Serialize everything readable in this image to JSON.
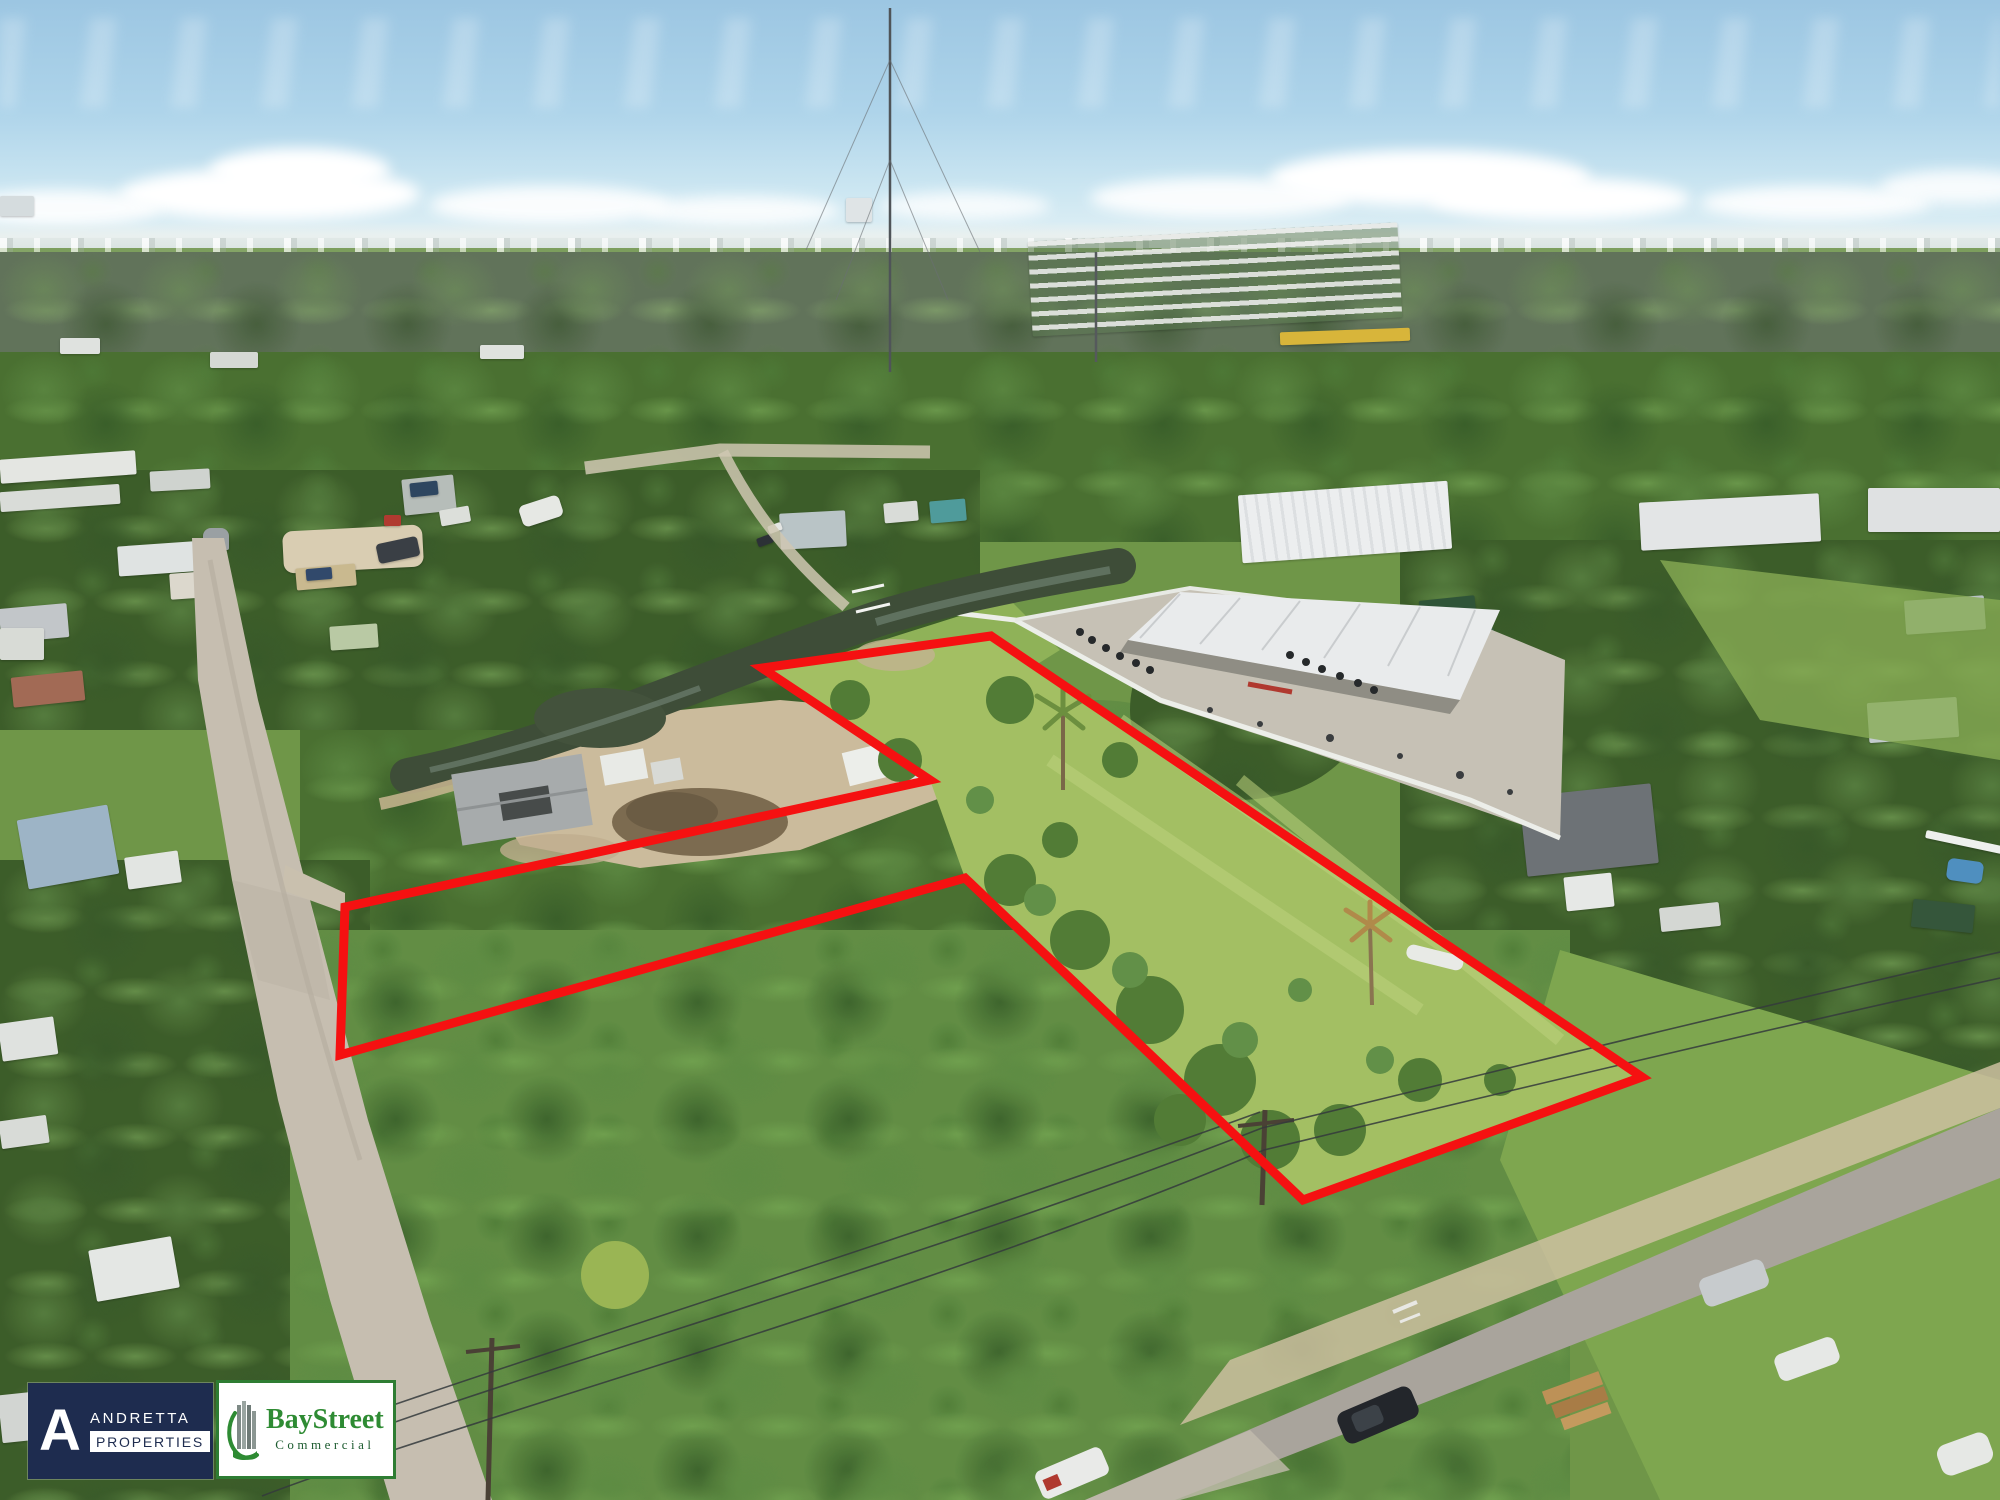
{
  "branding": {
    "andretta": {
      "monogram": "A",
      "name": "ANDRETTA",
      "division": "PROPERTIES",
      "colors": {
        "background": "#1e2c4f",
        "text": "#ffffff",
        "division_bg": "#ffffff",
        "division_text": "#1e2c4f"
      }
    },
    "baystreet": {
      "name": "BayStreet",
      "division": "Commercial",
      "colors": {
        "background": "#ffffff",
        "border": "#2e7d33",
        "name_text": "#2e8b33",
        "division_text": "#1d5c30"
      }
    }
  },
  "overlay": {
    "boundary_color": "#f51111",
    "stroke_width": "9",
    "points": "991,636 1642,1077 1303,1200 965,878 340,1055 345,907 930,780 762,668"
  }
}
